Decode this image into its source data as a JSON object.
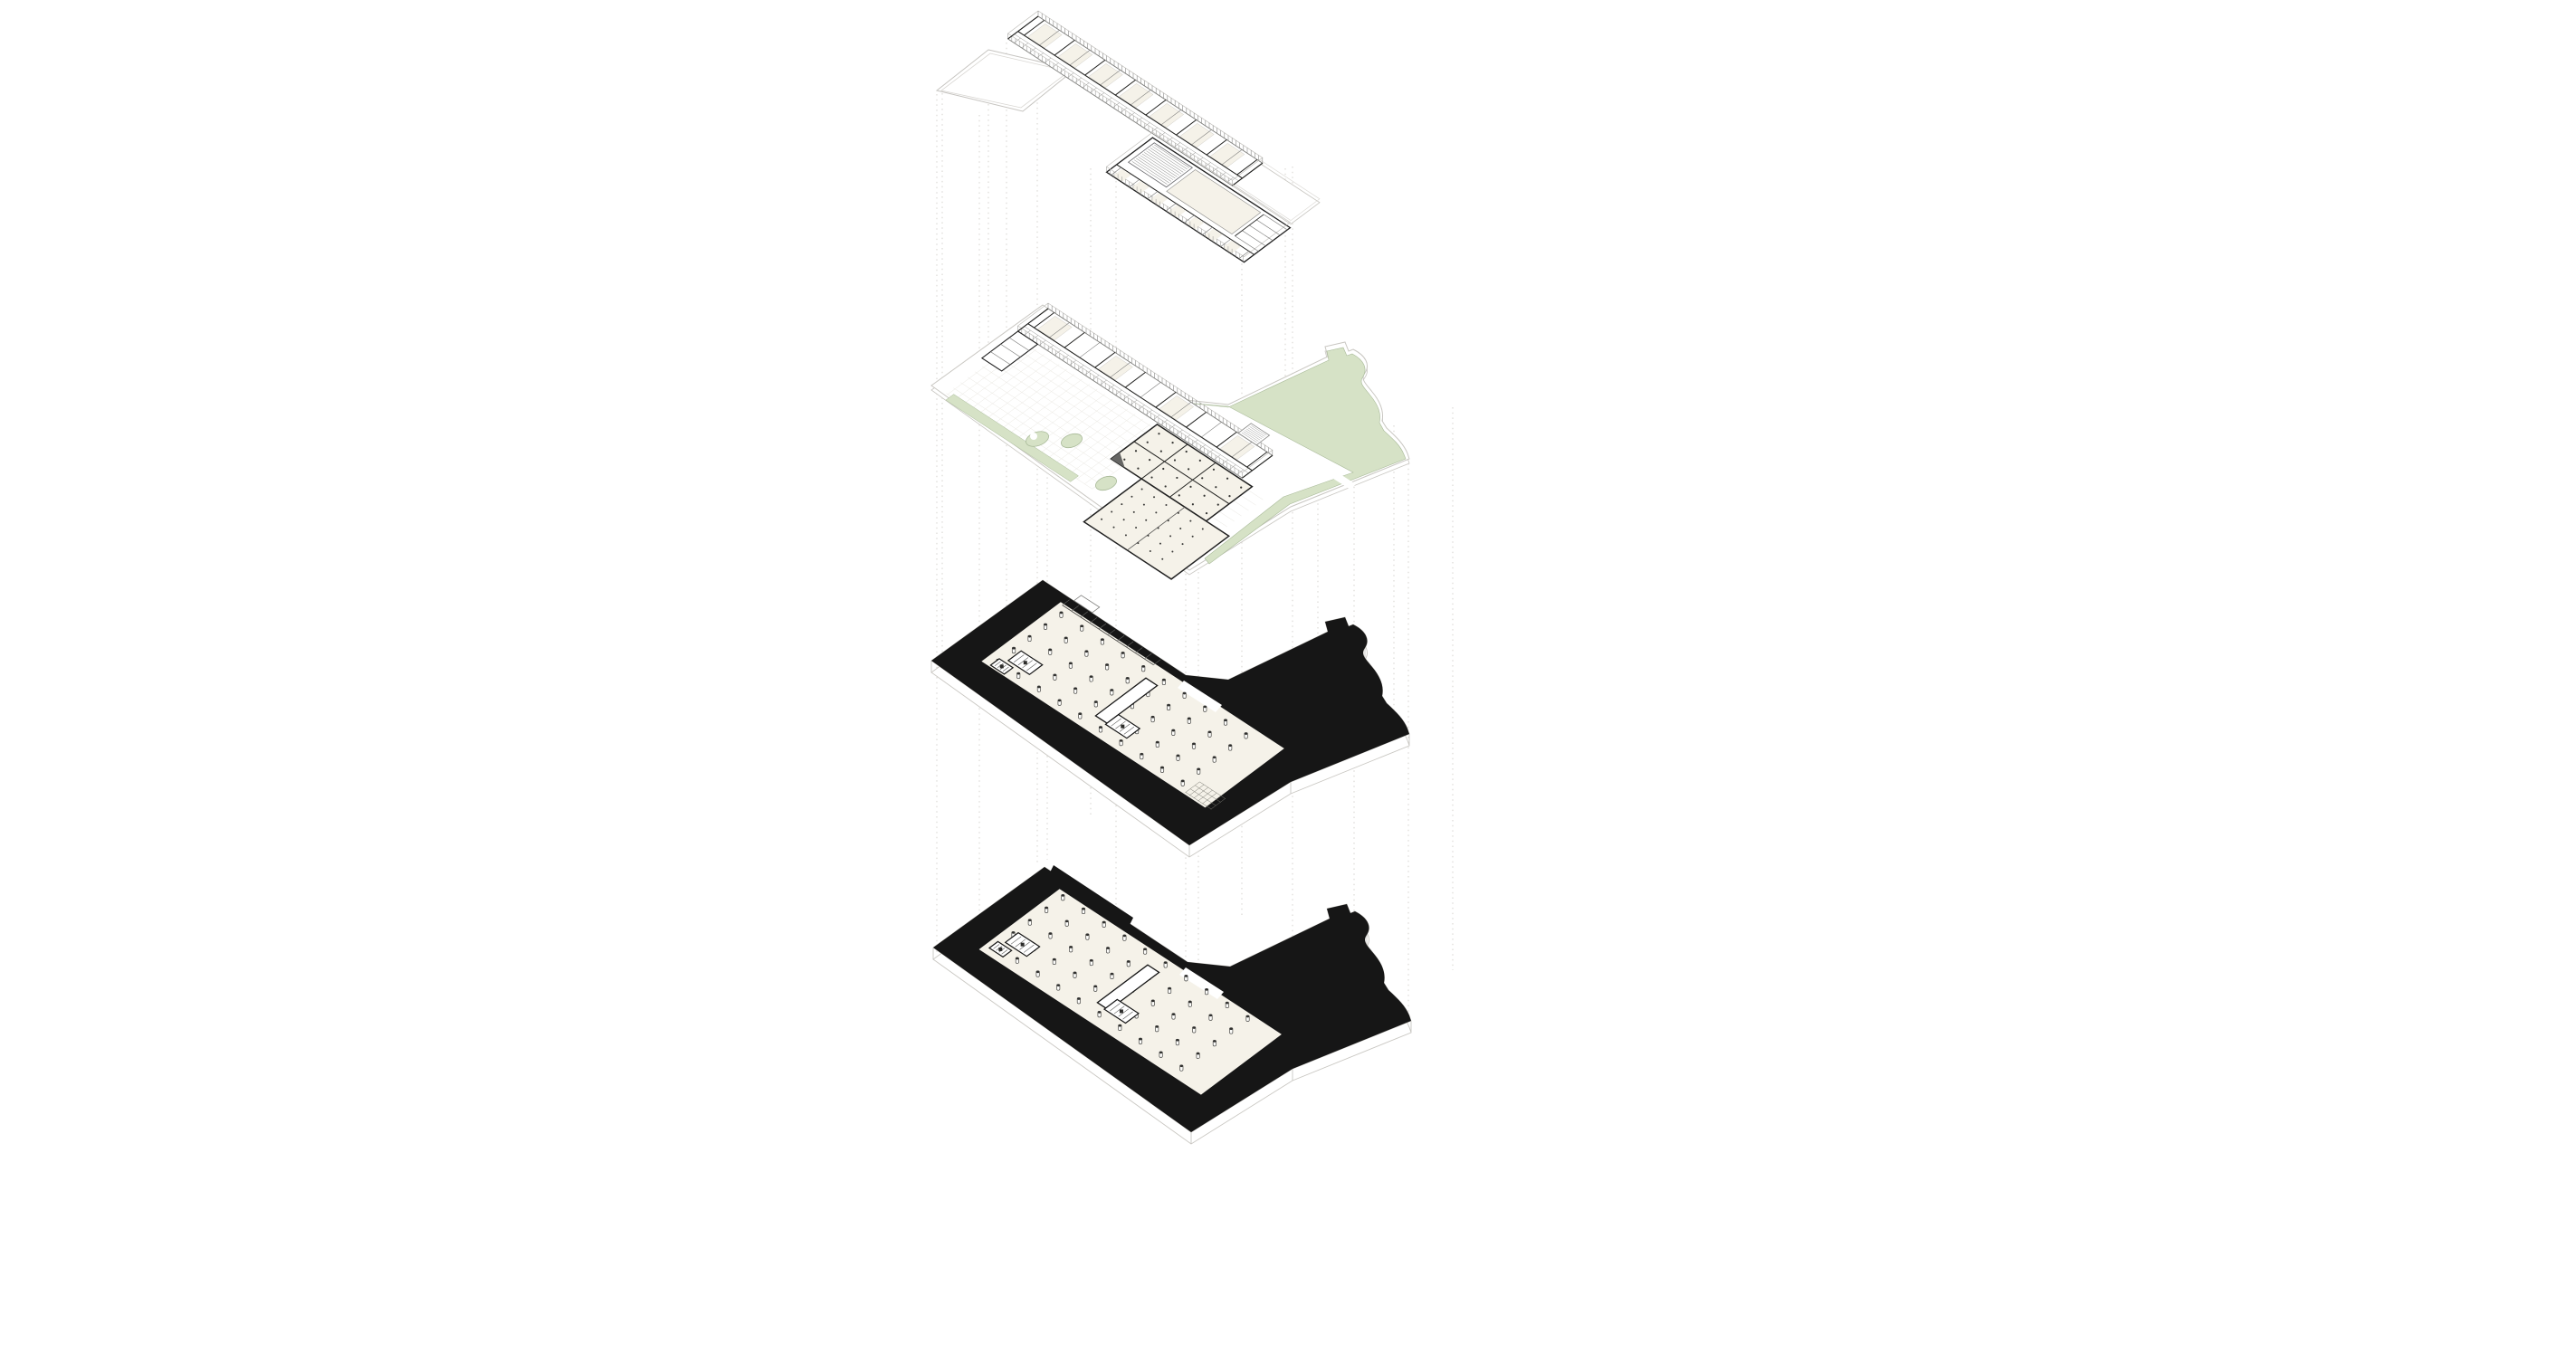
{
  "figure": {
    "type": "exploded-axonometric-floor-plans",
    "subject": "four stacked building levels connected by dotted projection lines",
    "levels": [
      {
        "id": "level-1",
        "name": "upper floor plan"
      },
      {
        "id": "level-2",
        "name": "ground floor plan with landscape"
      },
      {
        "id": "level-3",
        "name": "basement level 1 plan"
      },
      {
        "id": "level-4",
        "name": "basement level 2 plan"
      }
    ],
    "colors": {
      "background": "#ffffff",
      "wall_dark": "#212121",
      "wall_mid": "#7d7d7a",
      "edge_light": "#c9c7c2",
      "floor_cream": "#f5f2e9",
      "green_fill": "#d6e2c6",
      "green_edge": "#a9ba99",
      "poche_black": "#161616",
      "grid_faint": "#e9e7e1",
      "guide_dotted": "#cbc8c2"
    }
  }
}
